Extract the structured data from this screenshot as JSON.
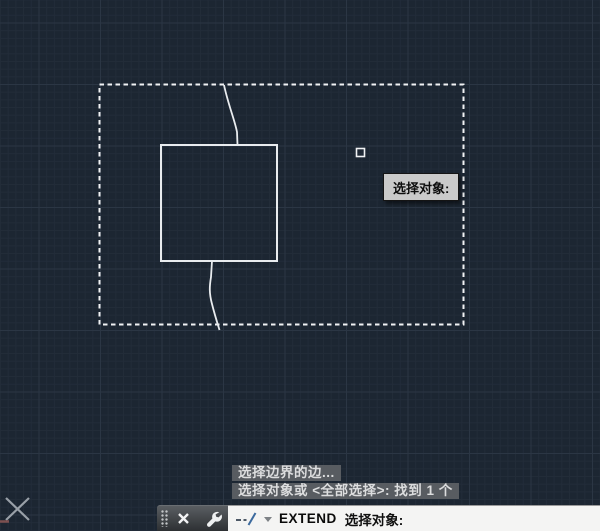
{
  "app": {
    "name": "AutoCAD drawing viewport",
    "theme": "dark"
  },
  "canvas": {
    "background_color": "#1c2632",
    "grid_minor_color": "#222c39",
    "grid_major_color": "#2b3644",
    "geometry_color": "#eef0f2",
    "shapes": [
      "selection-window-dashed-rectangle",
      "boundary-square",
      "upper-spline",
      "lower-spline",
      "pickbox-cursor",
      "ucs-icon"
    ]
  },
  "tooltip": {
    "text": "选择对象:",
    "background": "#cacaca"
  },
  "history": {
    "lines": [
      "选择边界的边...",
      "选择对象或 <全部选择>: 找到 1 个"
    ]
  },
  "command_bar": {
    "command_name": "EXTEND",
    "prompt": "选择对象:",
    "icons": [
      "grip-handle",
      "close-icon",
      "wrench-icon",
      "extend-command-icon",
      "chevron-down-icon"
    ]
  }
}
